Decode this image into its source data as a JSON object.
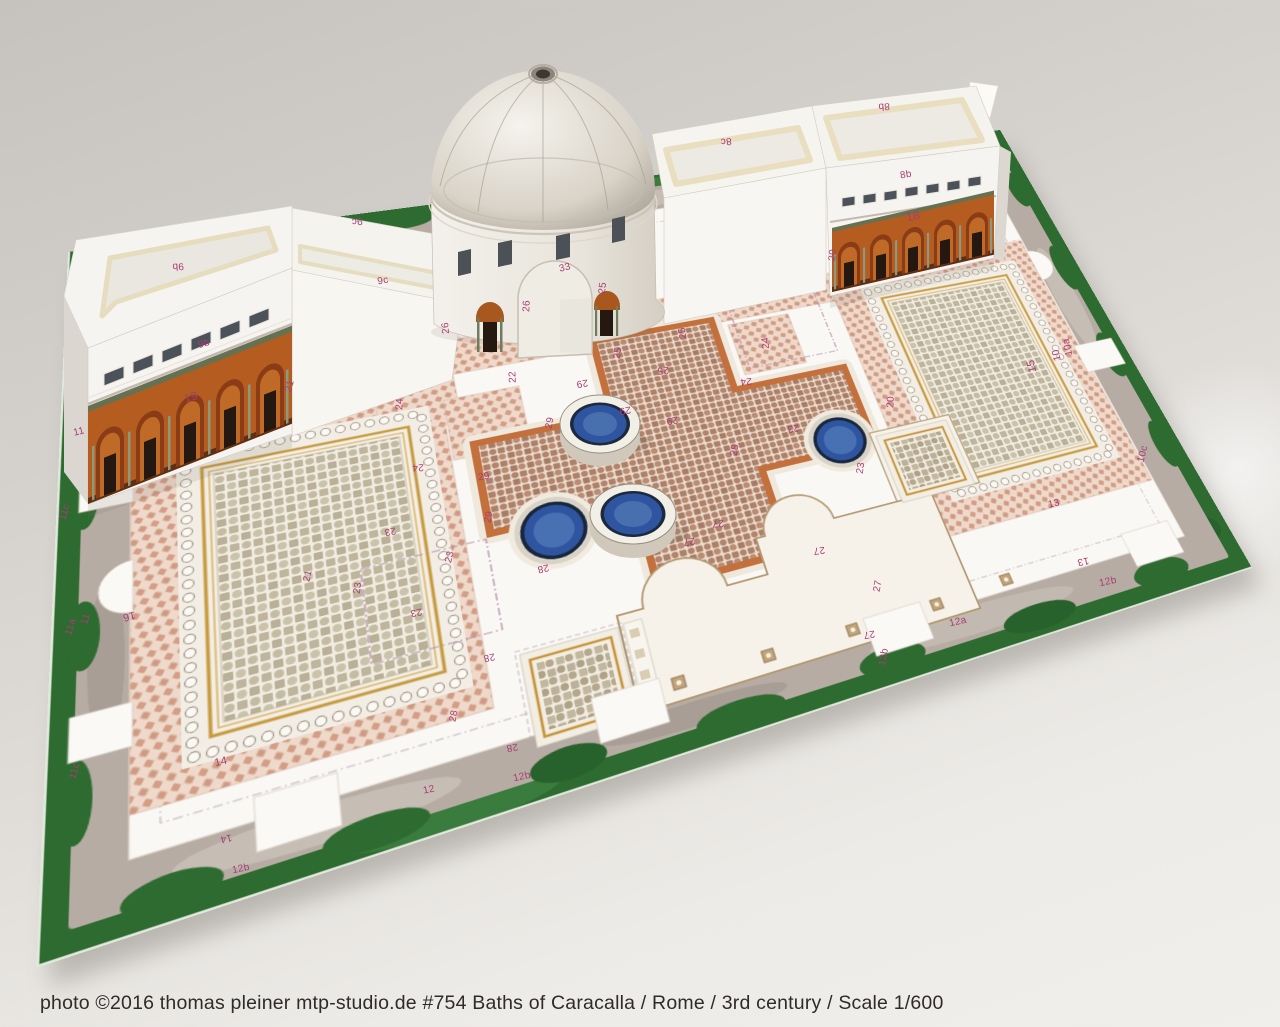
{
  "caption": "photo ©2016 thomas pleiner mtp-studio.de #754 Baths of Caracalla / Rome / 3rd century / Scale 1/600",
  "colors": {
    "backdrop": "#d3d0cc",
    "grass": "#2d6b30",
    "stone_path": "#b6aca3",
    "floor_white": "#faf8f4",
    "tile_checker": "#d49d85",
    "mosaic_cream": "#f1ece1",
    "cross_border_orange": "#c4703c",
    "gold_frame": "#c79a3e",
    "pool_blue": "#2f55a0",
    "arcade_orange": "#b55c20",
    "part_number_magenta": "#a83d74"
  },
  "part_labels": [
    {
      "t": "9b",
      "x": 178,
      "y": 266,
      "r": 176
    },
    {
      "t": "9b",
      "x": 204,
      "y": 344,
      "r": -17
    },
    {
      "t": "9c",
      "x": 357,
      "y": 221,
      "r": 174
    },
    {
      "t": "9c",
      "x": 383,
      "y": 281,
      "r": -11
    },
    {
      "t": "19",
      "x": 191,
      "y": 397,
      "r": -17,
      "s": 12
    },
    {
      "t": "21",
      "x": 290,
      "y": 386,
      "r": -75
    },
    {
      "t": "11",
      "x": 79,
      "y": 432,
      "r": -14
    },
    {
      "t": "33",
      "x": 565,
      "y": 268,
      "r": -13
    },
    {
      "t": "26",
      "x": 527,
      "y": 306,
      "r": -88
    },
    {
      "t": "25",
      "x": 603,
      "y": 288,
      "r": -84
    },
    {
      "t": "26",
      "x": 446,
      "y": 328,
      "r": -95
    },
    {
      "t": "8c",
      "x": 726,
      "y": 141,
      "r": 175
    },
    {
      "t": "8b",
      "x": 884,
      "y": 106,
      "r": 176
    },
    {
      "t": "8b",
      "x": 906,
      "y": 175,
      "r": -10
    },
    {
      "t": "18",
      "x": 913,
      "y": 216,
      "r": -10,
      "s": 12
    },
    {
      "t": "20",
      "x": 833,
      "y": 255,
      "r": -85
    },
    {
      "t": "10a",
      "x": 1068,
      "y": 347,
      "r": -103
    },
    {
      "t": "10",
      "x": 1057,
      "y": 355,
      "r": -103
    },
    {
      "t": "10c",
      "x": 1143,
      "y": 454,
      "r": -76
    },
    {
      "t": "15",
      "x": 1032,
      "y": 366,
      "r": -103,
      "s": 11
    },
    {
      "t": "13",
      "x": 1054,
      "y": 504,
      "r": -13
    },
    {
      "t": "13",
      "x": 1083,
      "y": 561,
      "r": 168
    },
    {
      "t": "12b",
      "x": 1108,
      "y": 582,
      "r": -12
    },
    {
      "t": "12a",
      "x": 958,
      "y": 622,
      "r": -13
    },
    {
      "t": "12b",
      "x": 884,
      "y": 657,
      "r": -80
    },
    {
      "t": "20",
      "x": 891,
      "y": 402,
      "r": -87
    },
    {
      "t": "23",
      "x": 793,
      "y": 428,
      "r": 170
    },
    {
      "t": "23",
      "x": 861,
      "y": 468,
      "r": -82
    },
    {
      "t": "22",
      "x": 513,
      "y": 377,
      "r": -92
    },
    {
      "t": "24",
      "x": 400,
      "y": 404,
      "r": -88
    },
    {
      "t": "24",
      "x": 418,
      "y": 467,
      "r": 178
    },
    {
      "t": "25",
      "x": 618,
      "y": 353,
      "r": -80
    },
    {
      "t": "25",
      "x": 663,
      "y": 370,
      "r": 175
    },
    {
      "t": "25",
      "x": 683,
      "y": 333,
      "r": -100
    },
    {
      "t": "24",
      "x": 746,
      "y": 381,
      "r": 175
    },
    {
      "t": "24",
      "x": 766,
      "y": 343,
      "r": -95
    },
    {
      "t": "29",
      "x": 582,
      "y": 383,
      "r": 170
    },
    {
      "t": "29",
      "x": 550,
      "y": 423,
      "r": -78
    },
    {
      "t": "29",
      "x": 625,
      "y": 410,
      "r": 170
    },
    {
      "t": "29",
      "x": 672,
      "y": 420,
      "r": 170
    },
    {
      "t": "29",
      "x": 484,
      "y": 477,
      "r": -10
    },
    {
      "t": "29",
      "x": 489,
      "y": 517,
      "r": -78
    },
    {
      "t": "28",
      "x": 735,
      "y": 450,
      "r": -80
    },
    {
      "t": "27",
      "x": 718,
      "y": 523,
      "r": 178
    },
    {
      "t": "27",
      "x": 689,
      "y": 541,
      "r": 172
    },
    {
      "t": "27",
      "x": 819,
      "y": 550,
      "r": 172
    },
    {
      "t": "27",
      "x": 878,
      "y": 586,
      "r": -80
    },
    {
      "t": "27",
      "x": 869,
      "y": 634,
      "r": 170
    },
    {
      "t": "28",
      "x": 543,
      "y": 568,
      "r": 167
    },
    {
      "t": "28",
      "x": 489,
      "y": 657,
      "r": 168
    },
    {
      "t": "28",
      "x": 454,
      "y": 716,
      "r": -78
    },
    {
      "t": "28",
      "x": 512,
      "y": 747,
      "r": 170
    },
    {
      "t": "23",
      "x": 390,
      "y": 531,
      "r": 168
    },
    {
      "t": "23",
      "x": 450,
      "y": 557,
      "r": -75
    },
    {
      "t": "23",
      "x": 358,
      "y": 588,
      "r": -82
    },
    {
      "t": "23",
      "x": 416,
      "y": 612,
      "r": 168
    },
    {
      "t": "21",
      "x": 308,
      "y": 576,
      "r": -78
    },
    {
      "t": "16",
      "x": 129,
      "y": 616,
      "r": 166,
      "s": 11
    },
    {
      "t": "14",
      "x": 221,
      "y": 762,
      "r": -13,
      "s": 11
    },
    {
      "t": "14",
      "x": 226,
      "y": 838,
      "r": 168
    },
    {
      "t": "12b",
      "x": 241,
      "y": 869,
      "r": -12
    },
    {
      "t": "12",
      "x": 429,
      "y": 790,
      "r": -12
    },
    {
      "t": "12b",
      "x": 522,
      "y": 777,
      "r": -12
    },
    {
      "t": "11c",
      "x": 65,
      "y": 512,
      "r": -74
    },
    {
      "t": "11a",
      "x": 71,
      "y": 627,
      "r": -75
    },
    {
      "t": "11",
      "x": 86,
      "y": 619,
      "r": -75
    },
    {
      "t": "11c",
      "x": 75,
      "y": 771,
      "r": -75
    }
  ]
}
